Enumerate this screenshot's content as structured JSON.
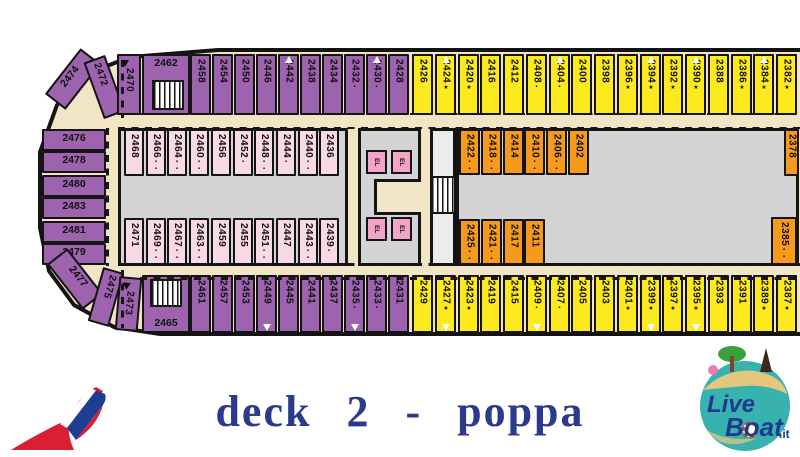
{
  "title": "deck 2 - poppa",
  "colors": {
    "interior_purple": "#9d63ae",
    "oceanview_yellow": "#fcea1f",
    "cabin_orange": "#f59a1d",
    "cabin_pink": "#f9d9e5",
    "elevator_pink": "#f2a3c6",
    "deck_beige": "#f1e5c5",
    "room_gray": "#d4d4d4",
    "title_navy": "#2b3a8e",
    "logo_teal": "#38b2af",
    "carnival_red": "#da1f33",
    "carnival_blue": "#1c3f94"
  },
  "deck": {
    "top_purple": [
      {
        "n": "2458"
      },
      {
        "n": "2454"
      },
      {
        "n": "2450"
      },
      {
        "n": "2446"
      },
      {
        "n": "2442",
        "t": "up"
      },
      {
        "n": "2438"
      },
      {
        "n": "2434"
      },
      {
        "n": "2432",
        "m": "▪"
      },
      {
        "n": "2430",
        "m": "▪",
        "t": "up"
      },
      {
        "n": "2428"
      }
    ],
    "top_yellow": [
      {
        "n": "2426"
      },
      {
        "n": "2424",
        "m": "★",
        "t": "up"
      },
      {
        "n": "2420",
        "m": "★"
      },
      {
        "n": "2416"
      },
      {
        "n": "2412"
      },
      {
        "n": "2408",
        "m": "▪"
      },
      {
        "n": "2404",
        "m": "▪",
        "t": "up"
      },
      {
        "n": "2400"
      },
      {
        "n": "2398"
      },
      {
        "n": "2396",
        "m": "★"
      },
      {
        "n": "2394",
        "m": "★",
        "t": "up"
      },
      {
        "n": "2392",
        "m": "★"
      },
      {
        "n": "2390",
        "m": "★",
        "t": "up"
      },
      {
        "n": "2388"
      },
      {
        "n": "2386",
        "m": "★"
      },
      {
        "n": "2384",
        "m": "★",
        "t": "up"
      },
      {
        "n": "2382",
        "m": "★"
      }
    ],
    "row2": [
      {
        "n": "2468"
      },
      {
        "n": "2466",
        "m": "▪▪"
      },
      {
        "n": "2464",
        "m": "▪▪"
      },
      {
        "n": "2460",
        "m": "▪▪"
      },
      {
        "n": "2456"
      },
      {
        "n": "2452",
        "m": "▪"
      },
      {
        "n": "2448",
        "m": "▪▪"
      },
      {
        "n": "2444",
        "m": "▪"
      },
      {
        "n": "2440",
        "m": "▪▪"
      },
      {
        "n": "2436"
      }
    ],
    "row3": [
      {
        "n": "2471"
      },
      {
        "n": "2469",
        "m": "▪▪"
      },
      {
        "n": "2467",
        "m": "▪▪"
      },
      {
        "n": "2463",
        "m": "▪▪"
      },
      {
        "n": "2459"
      },
      {
        "n": "2455"
      },
      {
        "n": "2451",
        "m": "▪▪"
      },
      {
        "n": "2447"
      },
      {
        "n": "2443",
        "m": "▪▪"
      },
      {
        "n": "2439",
        "m": "▪"
      }
    ],
    "orange_top": [
      {
        "n": "2422",
        "m": "▪▪"
      },
      {
        "n": "2418",
        "m": "▪▪"
      },
      {
        "n": "2414"
      },
      {
        "n": "2410",
        "m": "▪▪"
      },
      {
        "n": "2406",
        "m": "▪▪"
      },
      {
        "n": "2402"
      }
    ],
    "orange_bottom": [
      {
        "n": "2425",
        "m": "▪▪"
      },
      {
        "n": "2421",
        "m": "▪▪"
      },
      {
        "n": "2417"
      },
      {
        "n": "2411"
      }
    ],
    "bottom_purple": [
      {
        "n": "2461"
      },
      {
        "n": "2457"
      },
      {
        "n": "2453"
      },
      {
        "n": "2449",
        "t": "down"
      },
      {
        "n": "2445"
      },
      {
        "n": "2441"
      },
      {
        "n": "2437"
      },
      {
        "n": "2435",
        "m": "▪",
        "t": "down"
      },
      {
        "n": "2433",
        "m": "▪"
      },
      {
        "n": "2431"
      }
    ],
    "bottom_yellow": [
      {
        "n": "2429"
      },
      {
        "n": "2427",
        "m": "★",
        "t": "down"
      },
      {
        "n": "2423",
        "m": "★"
      },
      {
        "n": "2419"
      },
      {
        "n": "2415"
      },
      {
        "n": "2409",
        "m": "▪",
        "t": "down"
      },
      {
        "n": "2407",
        "m": "▪"
      },
      {
        "n": "2405"
      },
      {
        "n": "2403"
      },
      {
        "n": "2401",
        "m": "★"
      },
      {
        "n": "2399",
        "m": "★",
        "t": "down"
      },
      {
        "n": "2397",
        "m": "★"
      },
      {
        "n": "2395",
        "m": "★",
        "t": "down"
      },
      {
        "n": "2393"
      },
      {
        "n": "2391"
      },
      {
        "n": "2389",
        "m": "★"
      },
      {
        "n": "2387",
        "m": "★"
      }
    ],
    "left_stack": [
      {
        "n": "2476"
      },
      {
        "n": "2478"
      },
      {
        "n": "2480"
      },
      {
        "n": "2483"
      },
      {
        "n": "2481"
      },
      {
        "n": "2479"
      }
    ],
    "stern_top": [
      {
        "n": "2474"
      },
      {
        "n": "2472"
      },
      {
        "n": "2470",
        "bt": true
      }
    ],
    "stern_bottom": [
      {
        "n": "2477"
      },
      {
        "n": "2475"
      },
      {
        "n": "2473",
        "bt": true
      }
    ],
    "room_top": {
      "n": "2462"
    },
    "room_bottom": {
      "n": "2465"
    },
    "corner_top": {
      "n": "2378"
    },
    "corner_bottom": {
      "n": "2385",
      "m": "▪▪"
    },
    "elevator_label": "EL"
  },
  "logos": {
    "liveboat_line1": "Live",
    "liveboat_line2": "Boat",
    "liveboat_suffix": ".it"
  }
}
